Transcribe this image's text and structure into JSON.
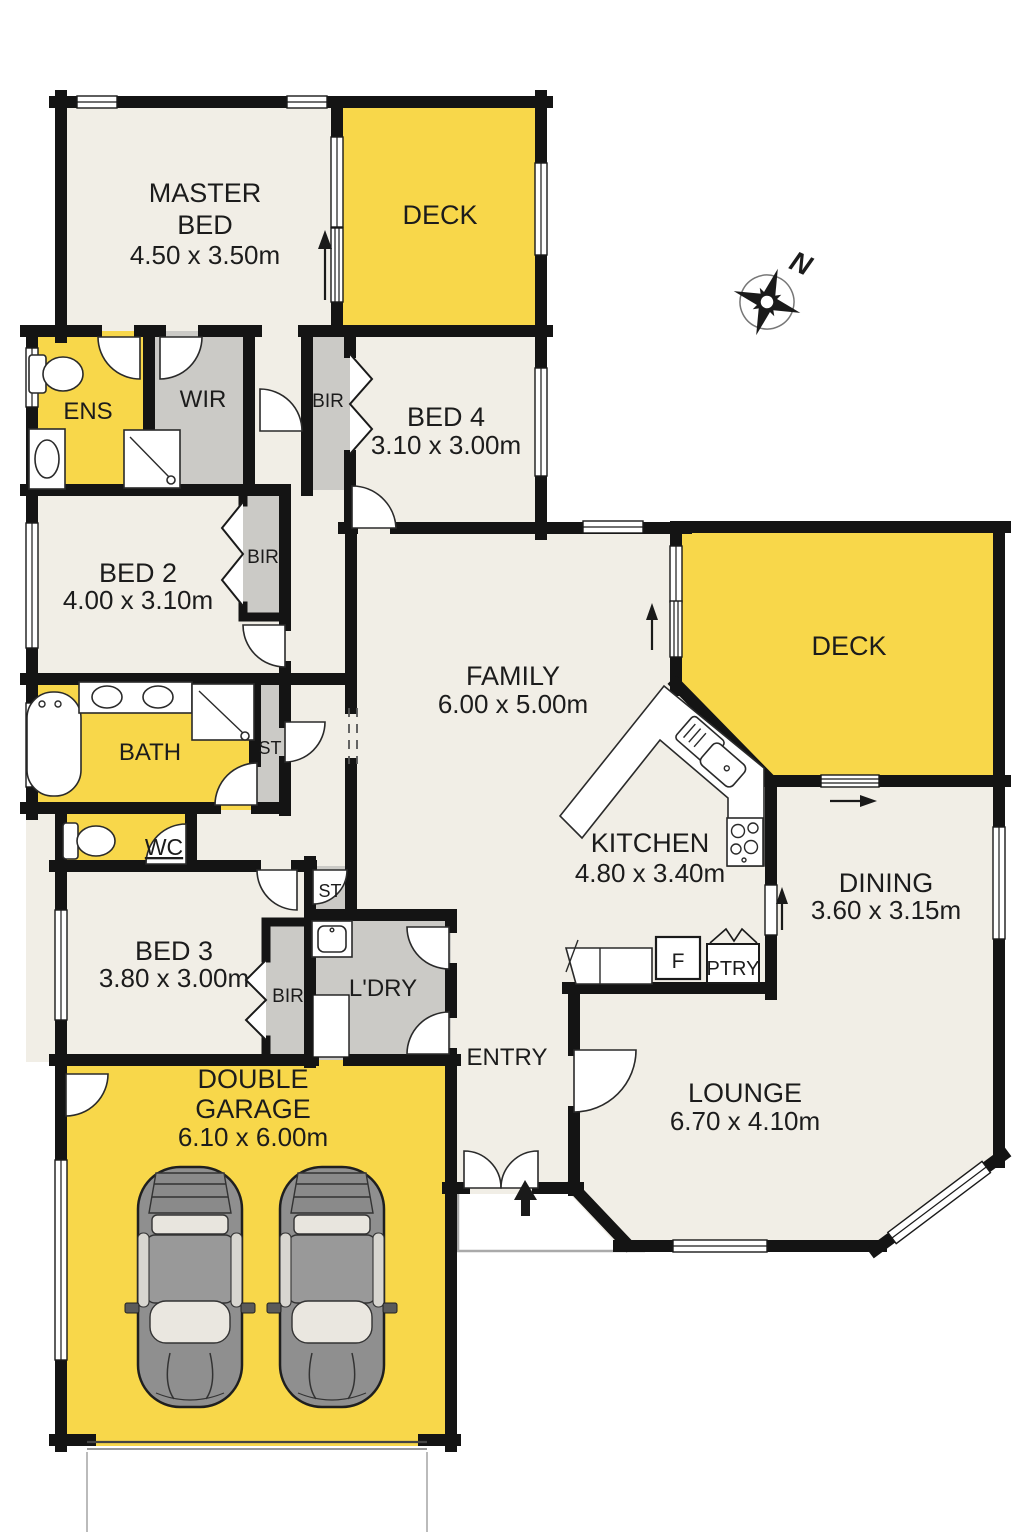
{
  "plan_title": "Residential floor plan",
  "colors": {
    "wall": "#141414",
    "floor": "#F1EEE6",
    "deck_yellow": "#F8D74A",
    "closet_gray": "#CBCAC6",
    "fixture_white": "#FFFFFF",
    "car_gray": "#8F8F8F"
  },
  "compass": {
    "north_label": "N"
  },
  "rooms": {
    "master_bed": {
      "line1": "MASTER",
      "line2": "BED",
      "dims": "4.50 x 3.50m"
    },
    "deck_top": {
      "line1": "DECK"
    },
    "ens": {
      "line1": "ENS"
    },
    "wir": {
      "line1": "WIR"
    },
    "bir_bed4": {
      "line1": "BIR"
    },
    "bed4": {
      "line1": "BED 4",
      "dims": "3.10 x 3.00m"
    },
    "bed2": {
      "line1": "BED 2",
      "dims": "4.00 x 3.10m"
    },
    "bir_bed2": {
      "line1": "BIR"
    },
    "bath": {
      "line1": "BATH"
    },
    "st_bath": {
      "line1": "ST"
    },
    "wc": {
      "line1": "WC"
    },
    "bed3": {
      "line1": "BED 3",
      "dims": "3.80 x 3.00m"
    },
    "bir_bed3": {
      "line1": "BIR"
    },
    "st_hall": {
      "line1": "ST"
    },
    "laundry": {
      "line1": "L'DRY"
    },
    "family": {
      "line1": "FAMILY",
      "dims": "6.00 x 5.00m"
    },
    "kitchen": {
      "line1": "KITCHEN",
      "dims": "4.80 x 3.40m"
    },
    "deck_right": {
      "line1": "DECK"
    },
    "dining": {
      "line1": "DINING",
      "dims": "3.60 x 3.15m"
    },
    "entry": {
      "line1": "ENTRY"
    },
    "lounge": {
      "line1": "LOUNGE",
      "dims": "6.70 x 4.10m"
    },
    "garage": {
      "line1": "DOUBLE",
      "line2": "GARAGE",
      "dims": "6.10 x 6.00m"
    }
  },
  "fixtures": {
    "fridge": "F",
    "pantry": "PTRY"
  }
}
